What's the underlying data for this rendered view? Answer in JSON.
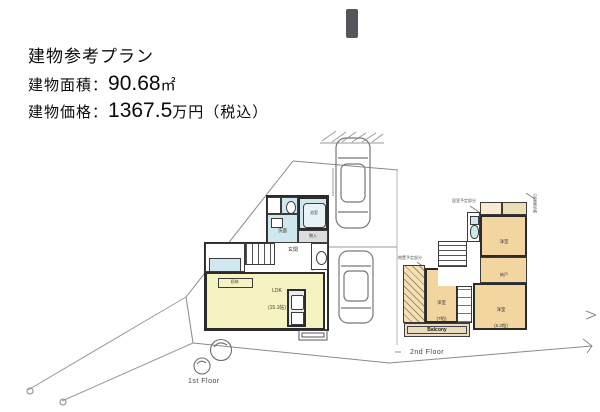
{
  "header": {
    "title": "建物参考プラン",
    "area_label": "建物面積：",
    "area_value": "90.68",
    "area_unit": "㎡",
    "price_label": "建物価格：",
    "price_value": "1367.5",
    "price_unit": "万円（税込）"
  },
  "floor1": {
    "caption": "1st Floor",
    "ldk_name": "LDK",
    "ldk_size": "(15.1帖)",
    "hall": "玄関",
    "bath": "浴室",
    "wash": "洗面",
    "closet": "物入",
    "counter": "収納"
  },
  "floor2": {
    "caption": "2nd Floor",
    "balcony": "Balcony",
    "rooms": {
      "left": {
        "name": "洋室",
        "size": "(7帖)"
      },
      "top": {
        "name": "洋室",
        "size": "(6.7帖)"
      },
      "mid": {
        "name": "納戸",
        "size": "(3帖)"
      },
      "bottom": {
        "name": "洋室",
        "size": "(5.2帖)"
      }
    },
    "ann_top": "居室予定部分",
    "ann_left": "物置予定部分",
    "ann_right": "小屋裏収納"
  },
  "colors": {
    "ldk": "#f6f3c3",
    "bedroom": "#f3d5a0",
    "wet_room": "#cfe7ee",
    "closet_gray": "#dcdcdc",
    "wall": "#2b2b2b",
    "site_line": "#8a8a8a"
  }
}
